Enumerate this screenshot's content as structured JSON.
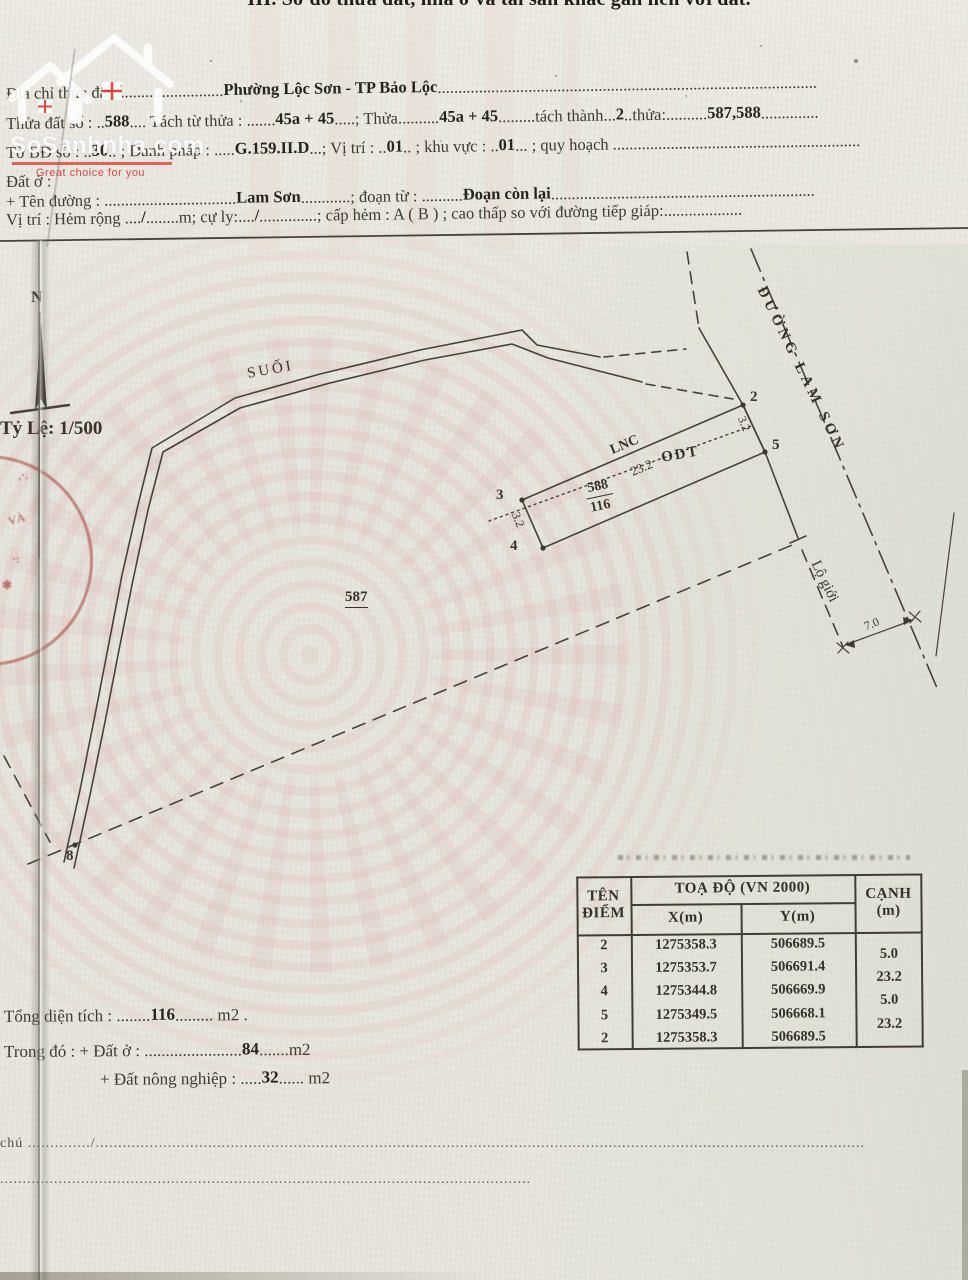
{
  "page": {
    "section_title": "III. Sơ đồ thửa đất, nhà ở và tài sản khác gắn liền với đất."
  },
  "watermark": {
    "brand": "SoSanhnha.com",
    "tagline": "Great choice for you",
    "accent": "#d8433a"
  },
  "form": {
    "lines": [
      [
        {
          "c": "l",
          "t": "Địa chỉ thửa đất: "
        },
        {
          "c": "l",
          "t": "........................."
        },
        {
          "c": "v",
          "t": "Phường Lộc Sơn - TP Bảo Lộc"
        },
        {
          "c": "l",
          "t": "............................................................................................"
        }
      ],
      [
        {
          "c": "l",
          "t": "Thửa đất số : .."
        },
        {
          "c": "v",
          "t": "588"
        },
        {
          "c": "l",
          "t": ".... Tách từ thửa : ......."
        },
        {
          "c": "v",
          "t": "45a + 45"
        },
        {
          "c": "l",
          "t": ".....; Thửa.........."
        },
        {
          "c": "v",
          "t": "45a + 45"
        },
        {
          "c": "l",
          "t": ".........tách thành..."
        },
        {
          "c": "v",
          "t": "2"
        },
        {
          "c": "l",
          "t": "..thửa:.........."
        },
        {
          "c": "v",
          "t": "587,588"
        },
        {
          "c": "l",
          "t": ".............."
        }
      ],
      [
        {
          "c": "l",
          "t": "Tờ BĐ số : .."
        },
        {
          "c": "v",
          "t": "30"
        },
        {
          "c": "l",
          "t": ".. ; Danh pháp : ....."
        },
        {
          "c": "v",
          "t": "G.159.II.D"
        },
        {
          "c": "l",
          "t": "...; Vị trí : .."
        },
        {
          "c": "v",
          "t": "01"
        },
        {
          "c": "l",
          "t": ".. ; khu vực : .."
        },
        {
          "c": "v",
          "t": "01"
        },
        {
          "c": "l",
          "t": "... ; quy hoạch ............................................................"
        }
      ],
      [
        {
          "c": "l",
          "t": "Đất ở :"
        }
      ],
      [
        {
          "c": "l",
          "t": "+ Tên đường : ................................"
        },
        {
          "c": "v",
          "t": "Lam Sơn"
        },
        {
          "c": "l",
          "t": "............; đoạn từ : .........."
        },
        {
          "c": "v",
          "t": "Đoạn còn lại"
        },
        {
          "c": "l",
          "t": "................................................................"
        }
      ],
      [
        {
          "c": "l",
          "t": "Vị trí :   Hẻm rộng ...."
        },
        {
          "c": "v",
          "t": "/"
        },
        {
          "c": "l",
          "t": "........m; cự ly:...."
        },
        {
          "c": "v",
          "t": "/"
        },
        {
          "c": "l",
          "t": "..............; cấp hẻm : A ( B ) ; cao thấp so với đường tiếp giáp:..................."
        }
      ]
    ]
  },
  "totals": {
    "lines": [
      [
        {
          "c": "l",
          "t": "Tổng diện tích : ........"
        },
        {
          "c": "v",
          "t": "116"
        },
        {
          "c": "l",
          "t": "......... m2 ."
        }
      ],
      [
        {
          "c": "l",
          "t": "Trong đó :   + Đất ở : ......................."
        },
        {
          "c": "v",
          "t": "84"
        },
        {
          "c": "l",
          "t": ".......m2"
        }
      ],
      [
        {
          "c": "l",
          "t": "+ Đất nông nghiệp : ....."
        },
        {
          "c": "v",
          "t": "32"
        },
        {
          "c": "l",
          "t": "...... m2"
        }
      ]
    ]
  },
  "notes": {
    "line1": "chú  ............../...........................................................................................................................................................................",
    "line2": "......................................................................................................................"
  },
  "map": {
    "scale": "1/500",
    "labels": [
      {
        "id": "north-label",
        "x": 31,
        "y": 289,
        "cls": "b s16",
        "text": "N"
      },
      {
        "id": "scale-label",
        "x": 0,
        "y": 418,
        "cls": "b s19",
        "text": "Tỷ Lệ: 1/500"
      },
      {
        "id": "stream-label",
        "x": 246,
        "y": 366,
        "rot": -10,
        "cls": "sp3 s15",
        "text": "SUỐI"
      },
      {
        "id": "parcel-587-label",
        "x": 345,
        "y": 589,
        "cls": "b s15 und",
        "text": "587"
      },
      {
        "id": "vertex-2-label",
        "x": 750,
        "y": 389,
        "cls": "b s15",
        "text": "2"
      },
      {
        "id": "vertex-5-label",
        "x": 772,
        "y": 437,
        "cls": "b s15",
        "text": "5"
      },
      {
        "id": "vertex-3-label",
        "x": 496,
        "y": 487,
        "cls": "b s15",
        "text": "3"
      },
      {
        "id": "vertex-4-label",
        "x": 510,
        "y": 538,
        "cls": "b s15",
        "text": "4"
      },
      {
        "id": "vertex-8-label",
        "x": 66,
        "y": 848,
        "cls": "b s15",
        "text": "8"
      },
      {
        "id": "landuse-lnc-label",
        "x": 608,
        "y": 444,
        "rot": -23,
        "cls": "b s14",
        "text": "LNC"
      },
      {
        "id": "division-length",
        "x": 628,
        "y": 465,
        "rot": -23,
        "cls": "s13",
        "text": "23.2"
      },
      {
        "id": "landuse-odt-label",
        "x": 660,
        "y": 450,
        "rot": -10,
        "cls": "b s15 sp2",
        "text": "ODT"
      },
      {
        "id": "parcel-number",
        "x": 583,
        "y": 482,
        "rot": -12,
        "cls": "b s14 fractop",
        "text": "588"
      },
      {
        "id": "parcel-area",
        "x": 589,
        "y": 501,
        "rot": -12,
        "cls": "b s14",
        "text": "116"
      },
      {
        "id": "edge-2-5-length",
        "x": 748,
        "y": 414,
        "rot": 68,
        "cls": "s12",
        "text": "3.2"
      },
      {
        "id": "edge-3-4-length",
        "x": 522,
        "y": 510,
        "rot": 68,
        "cls": "s12",
        "text": "3.2"
      },
      {
        "id": "road-name-label",
        "x": 768,
        "y": 284,
        "rot": 64,
        "cls": "b s15 sp4",
        "text": "ĐƯỜNG LAM SƠN"
      },
      {
        "id": "road-boundary-label",
        "x": 822,
        "y": 558,
        "rot": 64,
        "cls": "s15",
        "text": "Lộ giới"
      },
      {
        "id": "road-width-label",
        "x": 862,
        "y": 620,
        "rot": -22,
        "cls": "s12",
        "text": "7.0"
      }
    ]
  },
  "stamp": {
    "fragments": [
      {
        "t": ",·.",
        "x": 18,
        "y": 468,
        "rot": 0
      },
      {
        "t": "VÀ",
        "x": 8,
        "y": 512,
        "rot": -15
      },
      {
        "t": "·:",
        "x": 12,
        "y": 552,
        "rot": 0
      },
      {
        "t": "✱",
        "x": 2,
        "y": 578,
        "rot": 0
      }
    ]
  },
  "table": {
    "header": {
      "point": "TÊN\nĐIỂM",
      "coords": "TOẠ ĐỘ (VN 2000)",
      "x": "X(m)",
      "y": "Y(m)",
      "edge": "CẠNH\n(m)"
    },
    "rows": [
      [
        "2",
        "1275358.3",
        "506689.5"
      ],
      [
        "3",
        "1275353.7",
        "506691.4"
      ],
      [
        "4",
        "1275344.8",
        "506669.9"
      ],
      [
        "5",
        "1275349.5",
        "506668.1"
      ],
      [
        "2",
        "1275358.3",
        "506689.5"
      ]
    ],
    "edges": [
      "5.0",
      "23.2",
      "5.0",
      "23.2"
    ]
  }
}
